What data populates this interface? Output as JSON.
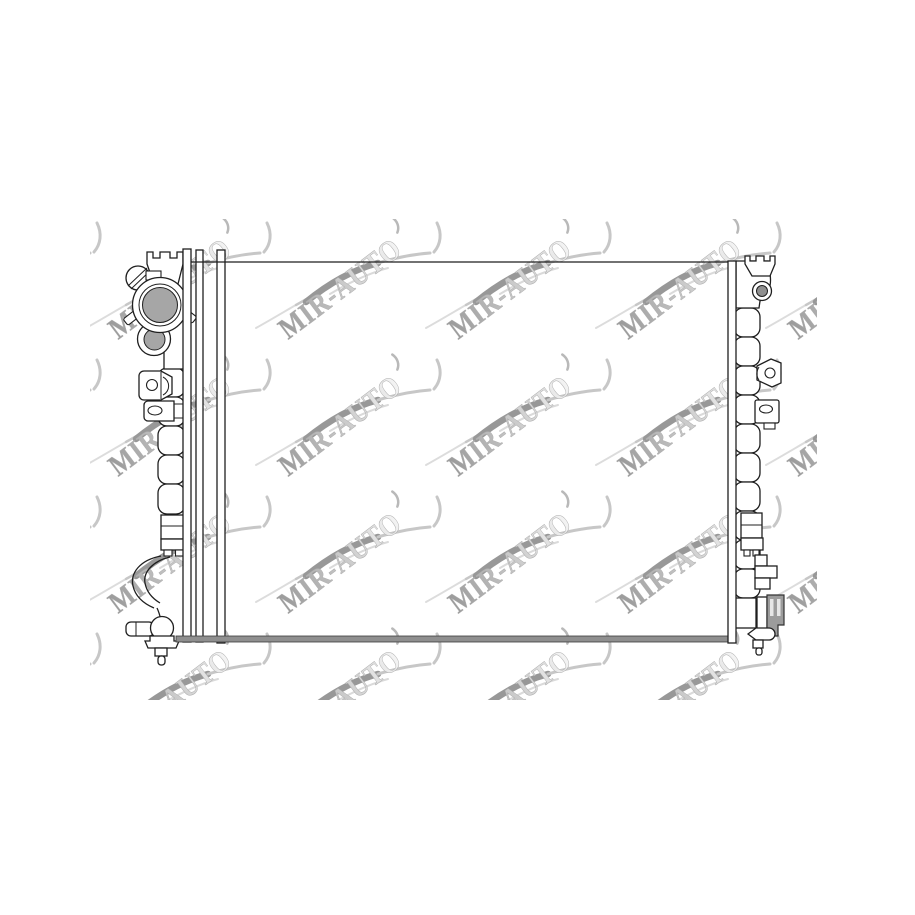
{
  "canvas": {
    "width": 915,
    "height": 915,
    "background": "#ffffff"
  },
  "image_area": {
    "x": 90,
    "y": 219,
    "width": 727,
    "height": 481
  },
  "watermark": {
    "text": "MIR-AUTO",
    "angle_deg": -37,
    "font_size": 30,
    "text_length": 145,
    "gradient_start": "#999999",
    "gradient_mid": "#cccccc",
    "gradient_end": "#f5f5f5",
    "text_stroke": "#aeaeae",
    "swoosh_light": "#c7c7c7",
    "swoosh_dark": "#989898",
    "grid": {
      "columns_x": [
        -52,
        118,
        288,
        458,
        628,
        798
      ],
      "row_baselines_y": [
        340,
        477,
        614,
        751
      ]
    }
  },
  "drawing": {
    "subject": "radiator-line-drawing",
    "line_color": "#1f1f1f",
    "filler_cap_gray": "#a6a6a6",
    "port_gray": "#8f8f8f",
    "connector_gray": "#9c9c9c",
    "core_bar_gray": "#8f8f8f",
    "left_bellows_count": 5,
    "right_bellows_count": 10
  }
}
